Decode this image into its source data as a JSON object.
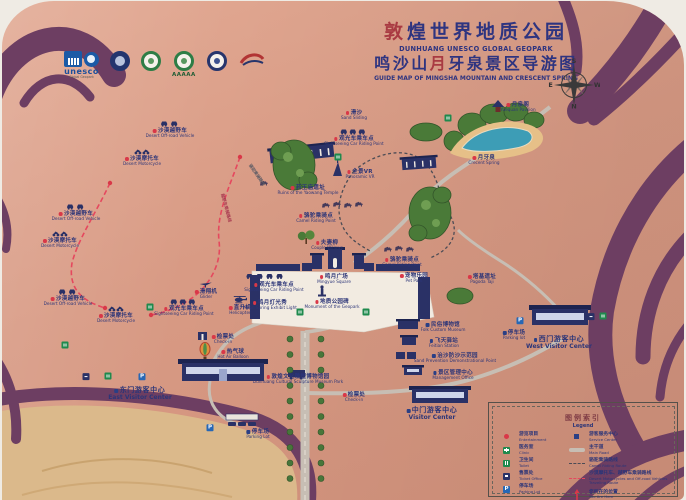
{
  "title": {
    "zh1_stamp": "敦",
    "zh1_rest": "煌世界地质公园",
    "en1": "DUNHUANG UNESCO GLOBAL GEOPARK",
    "zh2_pre": "鸣沙山",
    "zh2_stamp": "月",
    "zh2_post": "牙泉景区导游图",
    "en2": "GUIDE MAP OF MINGSHA MOUNTAIN AND CRESCENT SPRING"
  },
  "logos": {
    "unesco_caption": "unesco",
    "unesco_sub": "Global Geopark",
    "aaaaa_caption": "AAAAA"
  },
  "compass": {
    "top": "S",
    "bottom": "N",
    "left": "E",
    "right": "W"
  },
  "markers": {
    "parking_label": "P",
    "toilets": [
      {
        "x": 63,
        "y": 344
      },
      {
        "x": 106,
        "y": 375
      },
      {
        "x": 148,
        "y": 306
      },
      {
        "x": 298,
        "y": 311
      },
      {
        "x": 364,
        "y": 311
      },
      {
        "x": 336,
        "y": 156
      },
      {
        "x": 446,
        "y": 117
      },
      {
        "x": 601,
        "y": 315
      }
    ],
    "tickets": [
      {
        "x": 84,
        "y": 375
      },
      {
        "x": 589,
        "y": 315
      }
    ],
    "parkings": [
      {
        "x": 140,
        "y": 375
      },
      {
        "x": 518,
        "y": 319
      },
      {
        "x": 208,
        "y": 426
      }
    ]
  },
  "route_labels": [
    {
      "text": "越野车乘骑路线",
      "x": 223,
      "y": 192,
      "rot": 75,
      "color": "#a83a50"
    },
    {
      "text": "骆驼乘骑路线",
      "x": 250,
      "y": 162,
      "rot": 55,
      "color": "#5a5a64"
    }
  ],
  "pois": [
    {
      "name": "desert-offroad-1",
      "zh": "沙漠越野车",
      "en": "Desert Off-road Vehicle",
      "x": 168,
      "y": 118,
      "dot": "red",
      "icon": "jeep"
    },
    {
      "name": "desert-moto-1",
      "zh": "沙漠摩托车",
      "en": "Desert Motorcycle",
      "x": 140,
      "y": 147,
      "dot": "red",
      "icon": "moto"
    },
    {
      "name": "desert-offroad-2",
      "zh": "沙漠越野车",
      "en": "Desert Off-road Vehicle",
      "x": 74,
      "y": 201,
      "dot": "red",
      "icon": "jeep"
    },
    {
      "name": "desert-moto-2",
      "zh": "沙漠摩托车",
      "en": "Desert Motorcycle",
      "x": 58,
      "y": 229,
      "dot": "red",
      "icon": "moto"
    },
    {
      "name": "sand-sliding",
      "zh": "滑沙",
      "en": "Sand Sliding",
      "x": 352,
      "y": 109,
      "dot": "red"
    },
    {
      "name": "sightseeing-car-1",
      "zh": "观光车乘车点",
      "en": "Sightseeing Car Riding Point",
      "x": 352,
      "y": 126,
      "dot": "red",
      "icon": "jeep3"
    },
    {
      "name": "panoramic-vr",
      "zh": "全景VR",
      "en": "Panoramic VR",
      "x": 358,
      "y": 168,
      "dot": "red"
    },
    {
      "name": "yaowang-temple-ruins",
      "zh": "药王庙遗址",
      "en": "Ruins of the Yaowang Temple",
      "x": 306,
      "y": 184,
      "dot": "red"
    },
    {
      "name": "camel-riding-1",
      "zh": "骆驼乘骑点",
      "en": "Camel Riding Point",
      "x": 314,
      "y": 212,
      "dot": "red"
    },
    {
      "name": "couple-willows",
      "zh": "夫妻柳",
      "en": "Couple Willows",
      "x": 325,
      "y": 239,
      "dot": "red"
    },
    {
      "name": "yuequan-pavilion",
      "zh": "月泉阁",
      "en": "Yuequan Pavilion",
      "x": 516,
      "y": 101,
      "dot": "red"
    },
    {
      "name": "crescent-spring",
      "zh": "月牙泉",
      "en": "Crecent Spring",
      "x": 482,
      "y": 154,
      "dot": "red"
    },
    {
      "name": "mingyue-square",
      "zh": "鸣月广场",
      "en": "Mingyue Square",
      "x": 332,
      "y": 273,
      "dot": "red"
    },
    {
      "name": "geopark-monument",
      "zh": "地质公园碑",
      "en": "Monument of the Geopark",
      "x": 330,
      "y": 298,
      "dot": "red"
    },
    {
      "name": "camel-riding-2",
      "zh": "骆驼乘骑点",
      "en": "Camel Riding Point",
      "x": 400,
      "y": 256,
      "dot": "red"
    },
    {
      "name": "pet-park",
      "zh": "宠物乐园",
      "en": "Pet Park",
      "x": 412,
      "y": 272,
      "dot": "red"
    },
    {
      "name": "desert-offroad-3",
      "zh": "沙漠越野车",
      "en": "Desert Off-road Vehicle",
      "x": 66,
      "y": 286,
      "dot": "red",
      "icon": "jeep"
    },
    {
      "name": "desert-moto-3",
      "zh": "沙漠摩托车",
      "en": "Desert Motorcycle",
      "x": 114,
      "y": 304,
      "dot": "red",
      "icon": "moto"
    },
    {
      "name": "sightseeing-car-2",
      "zh": "观光车乘车点",
      "en": "Sightseeing Car Riding Point",
      "x": 182,
      "y": 296,
      "dot": "red",
      "icon": "jeep3"
    },
    {
      "name": "glider",
      "zh": "滑翔机",
      "en": "Glider",
      "x": 204,
      "y": 280,
      "dot": "red",
      "icon": "glider"
    },
    {
      "name": "helicopter",
      "zh": "直升机",
      "en": "Helicopter",
      "x": 238,
      "y": 294,
      "dot": "red",
      "icon": "heli"
    },
    {
      "name": "sightseeing-car-3",
      "zh": "观光车乘车点",
      "en": "Sightseeing Car Riding Point",
      "x": 272,
      "y": 281,
      "dot": "red"
    },
    {
      "name": "moon-light-show",
      "zh": "鸣月灯光秀",
      "en": "Moon Spring Exhibit Light",
      "x": 268,
      "y": 299,
      "dot": "red"
    },
    {
      "name": "check-in-east",
      "zh": "检票处",
      "en": "Check-in",
      "x": 221,
      "y": 333,
      "dot": "red"
    },
    {
      "name": "hot-air-balloon",
      "zh": "热气球",
      "en": "Hot Air Balloon",
      "x": 231,
      "y": 348,
      "dot": "red"
    },
    {
      "name": "east-visitor-center",
      "zh": "东门游客中心",
      "en": "East Visitor Center",
      "x": 138,
      "y": 386,
      "dot": "blue",
      "big": true
    },
    {
      "name": "sculpture-museum-park",
      "zh": "敦煌文化雕塑博物馆园",
      "en": "Dunhuang Cultural Sculpture Museum Park",
      "x": 296,
      "y": 373,
      "dot": "red"
    },
    {
      "name": "check-in-center",
      "zh": "检票处",
      "en": "Check-in",
      "x": 352,
      "y": 391,
      "dot": "red"
    },
    {
      "name": "center-visitor-center",
      "zh": "中门游客中心",
      "en": "Visitor Center",
      "x": 430,
      "y": 406,
      "dot": "blue",
      "big": true
    },
    {
      "name": "folk-custom-museum",
      "zh": "民俗博物馆",
      "en": "Folk Custom Museum",
      "x": 441,
      "y": 321,
      "dot": "blue"
    },
    {
      "name": "feitian-station",
      "zh": "飞天驿站",
      "en": "Feitian Station",
      "x": 442,
      "y": 337,
      "dot": "blue"
    },
    {
      "name": "sand-prevention-point",
      "zh": "治沙防沙示范园",
      "en": "Sand Prevention Demonstrational Point",
      "x": 453,
      "y": 352,
      "dot": "blue"
    },
    {
      "name": "management-office",
      "zh": "景区管理中心",
      "en": "Management Office",
      "x": 451,
      "y": 369,
      "dot": "blue"
    },
    {
      "name": "pagoda-taji",
      "zh": "塔基遗址",
      "en": "Pagoda Taji",
      "x": 480,
      "y": 273,
      "dot": "red"
    },
    {
      "name": "parking-west",
      "zh": "停车场",
      "en": "Parking lot",
      "x": 512,
      "y": 329,
      "dot": "blue"
    },
    {
      "name": "west-visitor-center",
      "zh": "西门游客中心",
      "en": "West Visitor Center",
      "x": 557,
      "y": 335,
      "dot": "blue",
      "big": true
    },
    {
      "name": "parking-main",
      "zh": "停车场",
      "en": "Parking Lot",
      "x": 256,
      "y": 428,
      "dot": "blue"
    }
  ],
  "legend": {
    "title_zh": "图例索引",
    "title_en": "Legend",
    "left": [
      {
        "icon": "red-dot",
        "zh": "游览项目",
        "en": "Entertainment"
      },
      {
        "icon": "clinic",
        "zh": "医务室",
        "en": "Clinic"
      },
      {
        "icon": "toilet",
        "zh": "卫生间",
        "en": "Toilet"
      },
      {
        "icon": "ticket",
        "zh": "售票处",
        "en": "Ticket Office"
      },
      {
        "icon": "parking",
        "zh": "停车场",
        "en": "Parking Lot"
      }
    ],
    "right": [
      {
        "icon": "blue-dot",
        "zh": "游客服务中心",
        "en": "Service Center"
      },
      {
        "icon": "road",
        "zh": "主干道",
        "en": "Main Road"
      },
      {
        "icon": "camel-route",
        "zh": "骆驼乘骑路线",
        "en": "Camel Riding Route"
      },
      {
        "icon": "red-route",
        "zh": "沙漠摩托车、越野车乘骑路线",
        "en": "Desert Motorcycles and Off-road Vehicles Traveling Route"
      },
      {
        "icon": "you-are-here",
        "zh": "您所在的位置",
        "en": "You Are Here"
      }
    ]
  }
}
